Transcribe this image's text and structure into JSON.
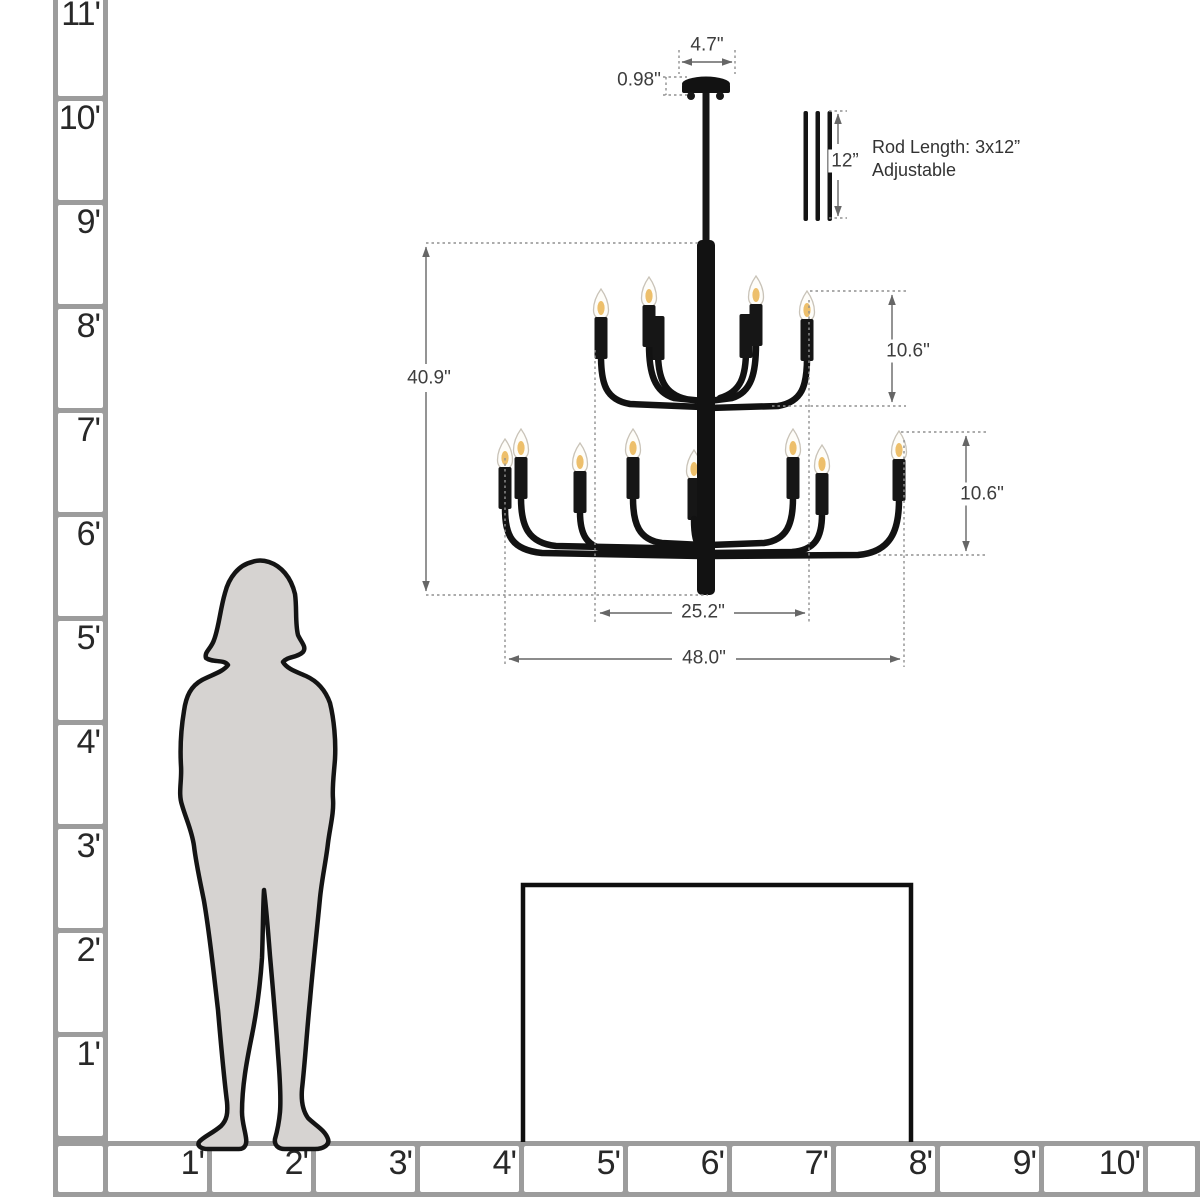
{
  "diagram": {
    "title_hint": "chandelier-size-diagram",
    "dimensions": {
      "canopy_width": "4.7\"",
      "canopy_height": "0.98\"",
      "rod_length": "12”",
      "overall_height": "40.9\"",
      "upper_tier_height": "10.6\"",
      "lower_tier_height": "10.6\"",
      "upper_tier_width": "25.2\"",
      "lower_tier_width": "48.0\""
    },
    "rod_note": {
      "line1": "Rod Length: 3x12”",
      "line2": "Adjustable"
    },
    "lights": {
      "upper_tier_count": 4,
      "lower_tier_count": 8
    },
    "colors": {
      "fixture_black": "#121212",
      "dimension_gray": "#666666",
      "dotted_gray": "#909090",
      "silhouette_gray": "#d6d3d1",
      "ruler_gray": "#9c9c9c",
      "bulb_warm": "#edbf6b",
      "table_black": "#0f0f0f"
    }
  },
  "rulers": {
    "vertical_feet": [
      "11'",
      "10'",
      "9'",
      "8'",
      "7'",
      "6'",
      "5'",
      "4'",
      "3'",
      "2'",
      "1'"
    ],
    "horizontal_feet": [
      "1'",
      "2'",
      "3'",
      "4'",
      "5'",
      "6'",
      "7'",
      "8'",
      "9'",
      "10'"
    ]
  }
}
